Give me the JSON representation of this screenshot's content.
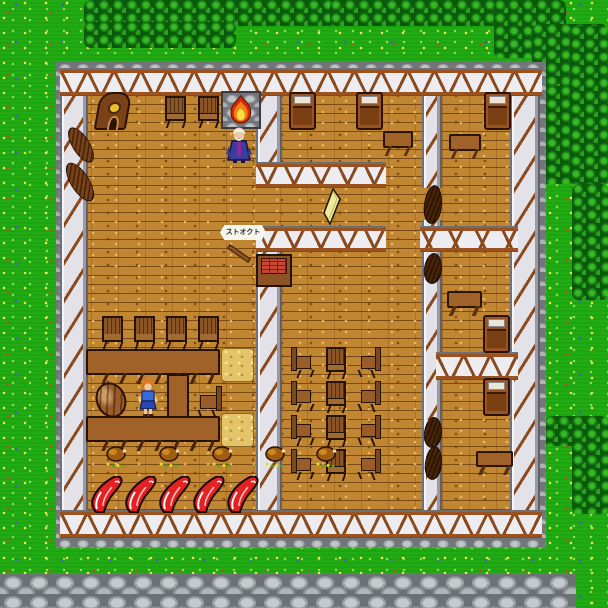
{
  "game": {
    "description": "Tile-based RPG town scene: tavern and inn interior with fireplace, counter, bedrooms",
    "viewport": {
      "width": 608,
      "height": 608
    },
    "sign_banner": {
      "text": "ストオクト"
    },
    "palette": {
      "grass": "#21ac13",
      "tree_dark": "#0a5a0c",
      "tree_light": "#38b828",
      "wood_floor": "#c08631",
      "beam_brown": "#8a4a1e",
      "wall_white": "#ededf1",
      "stone_gray": "#9aa0a4",
      "road_gray": "#9aa0a2",
      "meat_red": "#e42222",
      "fire_orange": "#f08018",
      "hay_yellow": "#e4c468",
      "cheese_yellow": "#f0eaa0",
      "npc_dress_blue": "#3a6ad8",
      "npc_robe_blue": "#3c3c9c"
    },
    "environment": {
      "trees": [
        {
          "x": 84,
          "y": 0,
          "w": 260,
          "h": 26
        },
        {
          "x": 84,
          "y": 22,
          "w": 152,
          "h": 26
        },
        {
          "x": 330,
          "y": 0,
          "w": 190,
          "h": 26
        },
        {
          "x": 494,
          "y": 0,
          "w": 72,
          "h": 58
        },
        {
          "x": 532,
          "y": 24,
          "w": 76,
          "h": 66
        },
        {
          "x": 532,
          "y": 86,
          "w": 44,
          "h": 98
        },
        {
          "x": 570,
          "y": 26,
          "w": 38,
          "h": 160
        },
        {
          "x": 572,
          "y": 184,
          "w": 36,
          "h": 116
        },
        {
          "x": 544,
          "y": 416,
          "w": 64,
          "h": 30
        },
        {
          "x": 572,
          "y": 442,
          "w": 36,
          "h": 72
        }
      ]
    },
    "entities": [
      {
        "type": "clock",
        "name": "grandfather-clock",
        "x": 96,
        "y": 92,
        "w": 36,
        "h": 40
      },
      {
        "type": "chair-s",
        "name": "chair",
        "x": 163,
        "y": 96,
        "w": 26,
        "h": 32
      },
      {
        "type": "chair-s",
        "name": "chair",
        "x": 196,
        "y": 96,
        "w": 26,
        "h": 32
      },
      {
        "type": "fireplace",
        "name": "fireplace",
        "x": 221,
        "y": 91,
        "w": 40,
        "h": 38
      },
      {
        "type": "npc-oldman",
        "name": "npc-old-man",
        "x": 225,
        "y": 124,
        "w": 28,
        "h": 40,
        "z": 7
      },
      {
        "type": "bed",
        "name": "bed",
        "x": 289,
        "y": 92,
        "w": 27,
        "h": 38
      },
      {
        "type": "bed",
        "name": "bed",
        "x": 356,
        "y": 92,
        "w": 27,
        "h": 38
      },
      {
        "type": "table",
        "name": "table",
        "x": 383,
        "y": 128,
        "w": 30,
        "h": 28
      },
      {
        "type": "bed",
        "name": "bed",
        "x": 484,
        "y": 92,
        "w": 27,
        "h": 38
      },
      {
        "type": "table",
        "name": "table",
        "x": 449,
        "y": 131,
        "w": 32,
        "h": 28
      },
      {
        "type": "shutter",
        "name": "window-shutter",
        "x": 69,
        "y": 125,
        "w": 24,
        "h": 40
      },
      {
        "type": "shutter",
        "name": "window-shutter",
        "x": 67,
        "y": 160,
        "w": 26,
        "h": 44
      },
      {
        "type": "cheese",
        "name": "cheese-wedge",
        "x": 322,
        "y": 188,
        "w": 20,
        "h": 38
      },
      {
        "type": "sign",
        "name": "sign-banner",
        "x": 220,
        "y": 225,
        "w": 46,
        "h": 15,
        "z": 8
      },
      {
        "type": "stick",
        "name": "wooden-stick",
        "x": 226,
        "y": 241,
        "w": 24,
        "h": 22
      },
      {
        "type": "crate",
        "name": "crate",
        "x": 256,
        "y": 254,
        "w": 36,
        "h": 33
      },
      {
        "type": "door",
        "name": "door",
        "x": 424,
        "y": 185,
        "w": 18,
        "h": 39
      },
      {
        "type": "door",
        "name": "door",
        "x": 424,
        "y": 253,
        "w": 18,
        "h": 31
      },
      {
        "type": "table",
        "name": "table",
        "x": 447,
        "y": 288,
        "w": 35,
        "h": 28
      },
      {
        "type": "bed",
        "name": "bed",
        "x": 483,
        "y": 315,
        "w": 27,
        "h": 38
      },
      {
        "type": "bed",
        "name": "bed",
        "x": 483,
        "y": 378,
        "w": 27,
        "h": 38
      },
      {
        "type": "table",
        "name": "table",
        "x": 476,
        "y": 448,
        "w": 37,
        "h": 27
      },
      {
        "type": "door",
        "name": "door",
        "x": 424,
        "y": 417,
        "w": 18,
        "h": 31
      },
      {
        "type": "door",
        "name": "door",
        "x": 425,
        "y": 446,
        "w": 17,
        "h": 34
      },
      {
        "type": "chair-s",
        "name": "chair",
        "x": 100,
        "y": 316,
        "w": 26,
        "h": 33
      },
      {
        "type": "chair-s",
        "name": "chair",
        "x": 132,
        "y": 316,
        "w": 26,
        "h": 33
      },
      {
        "type": "chair-s",
        "name": "chair",
        "x": 164,
        "y": 316,
        "w": 26,
        "h": 33
      },
      {
        "type": "chair-s",
        "name": "chair",
        "x": 196,
        "y": 316,
        "w": 26,
        "h": 33
      },
      {
        "type": "counter-h",
        "name": "counter-table",
        "x": 86,
        "y": 349,
        "w": 134,
        "h": 26
      },
      {
        "type": "counter-v",
        "name": "counter-table",
        "x": 167,
        "y": 374,
        "w": 22,
        "h": 44
      },
      {
        "type": "counter-h",
        "name": "counter-table",
        "x": 86,
        "y": 416,
        "w": 134,
        "h": 26
      },
      {
        "type": "barrel",
        "name": "barrel",
        "x": 96,
        "y": 382,
        "w": 30,
        "h": 36
      },
      {
        "type": "npc-waitress",
        "name": "npc-waitress",
        "x": 136,
        "y": 377,
        "w": 24,
        "h": 40,
        "z": 7
      },
      {
        "type": "chair-w",
        "name": "chair",
        "x": 196,
        "y": 386,
        "w": 27,
        "h": 32
      },
      {
        "type": "hay",
        "name": "hay-bale",
        "x": 221,
        "y": 348,
        "w": 33,
        "h": 34
      },
      {
        "type": "hay",
        "name": "hay-bale",
        "x": 221,
        "y": 413,
        "w": 33,
        "h": 34
      },
      {
        "type": "chair-e",
        "name": "chair",
        "x": 291,
        "y": 347,
        "w": 24,
        "h": 31
      },
      {
        "type": "chair-s",
        "name": "chair",
        "x": 324,
        "y": 347,
        "w": 25,
        "h": 32
      },
      {
        "type": "chair-w",
        "name": "chair",
        "x": 357,
        "y": 347,
        "w": 24,
        "h": 31
      },
      {
        "type": "chair-e",
        "name": "chair",
        "x": 291,
        "y": 381,
        "w": 24,
        "h": 31
      },
      {
        "type": "chair-s",
        "name": "chair",
        "x": 324,
        "y": 381,
        "w": 25,
        "h": 32
      },
      {
        "type": "chair-w",
        "name": "chair",
        "x": 357,
        "y": 381,
        "w": 24,
        "h": 31
      },
      {
        "type": "chair-e",
        "name": "chair",
        "x": 291,
        "y": 415,
        "w": 24,
        "h": 31
      },
      {
        "type": "chair-s",
        "name": "chair",
        "x": 324,
        "y": 415,
        "w": 25,
        "h": 32
      },
      {
        "type": "chair-w",
        "name": "chair",
        "x": 357,
        "y": 415,
        "w": 24,
        "h": 31
      },
      {
        "type": "chair-e",
        "name": "chair",
        "x": 291,
        "y": 449,
        "w": 24,
        "h": 31
      },
      {
        "type": "chair-s",
        "name": "chair",
        "x": 324,
        "y": 449,
        "w": 25,
        "h": 32
      },
      {
        "type": "chair-w",
        "name": "chair",
        "x": 357,
        "y": 449,
        "w": 24,
        "h": 31
      },
      {
        "type": "chicken",
        "name": "roast-chicken",
        "x": 103,
        "y": 445,
        "w": 26,
        "h": 23
      },
      {
        "type": "chicken",
        "name": "roast-chicken",
        "x": 156,
        "y": 445,
        "w": 26,
        "h": 23
      },
      {
        "type": "chicken",
        "name": "roast-chicken",
        "x": 209,
        "y": 445,
        "w": 26,
        "h": 23
      },
      {
        "type": "chicken",
        "name": "roast-chicken",
        "x": 262,
        "y": 445,
        "w": 26,
        "h": 23
      },
      {
        "type": "chicken",
        "name": "roast-chicken",
        "x": 313,
        "y": 445,
        "w": 26,
        "h": 23
      },
      {
        "type": "meat",
        "name": "meat-slab",
        "x": 91,
        "y": 476,
        "w": 34,
        "h": 37
      },
      {
        "type": "meat",
        "name": "meat-slab",
        "x": 125,
        "y": 476,
        "w": 34,
        "h": 37
      },
      {
        "type": "meat",
        "name": "meat-slab",
        "x": 159,
        "y": 476,
        "w": 34,
        "h": 37
      },
      {
        "type": "meat",
        "name": "meat-slab",
        "x": 193,
        "y": 476,
        "w": 34,
        "h": 37
      },
      {
        "type": "meat",
        "name": "meat-slab",
        "x": 227,
        "y": 476,
        "w": 34,
        "h": 37
      }
    ]
  }
}
